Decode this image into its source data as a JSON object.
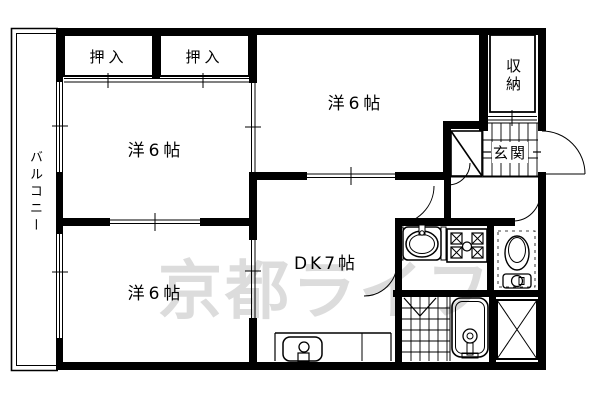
{
  "canvas": {
    "width": 600,
    "height": 400,
    "background": "#ffffff",
    "line_color": "#000000"
  },
  "floorplan": {
    "balcony": {
      "label": "バルコニー"
    },
    "closets": [
      {
        "label": "押入"
      },
      {
        "label": "押入"
      }
    ],
    "rooms": {
      "upper_left": {
        "label": "洋6帖"
      },
      "upper_right": {
        "label": "洋6帖"
      },
      "lower_left": {
        "label": "洋6帖"
      },
      "dining_kitchen": {
        "label": "DK7帖"
      },
      "storage": {
        "label": "収納"
      },
      "entrance": {
        "label": "玄関"
      }
    },
    "watermark": {
      "text": "京都ライフ",
      "color": "#dcdcdc"
    },
    "symbols": [
      "kitchen-sink",
      "gas-stove",
      "toilet",
      "bathtub",
      "counter-sink",
      "shoe-cabinet",
      "pipe-space-x",
      "tiled-floor",
      "door-swing-arc",
      "sliding-door",
      "window"
    ]
  }
}
